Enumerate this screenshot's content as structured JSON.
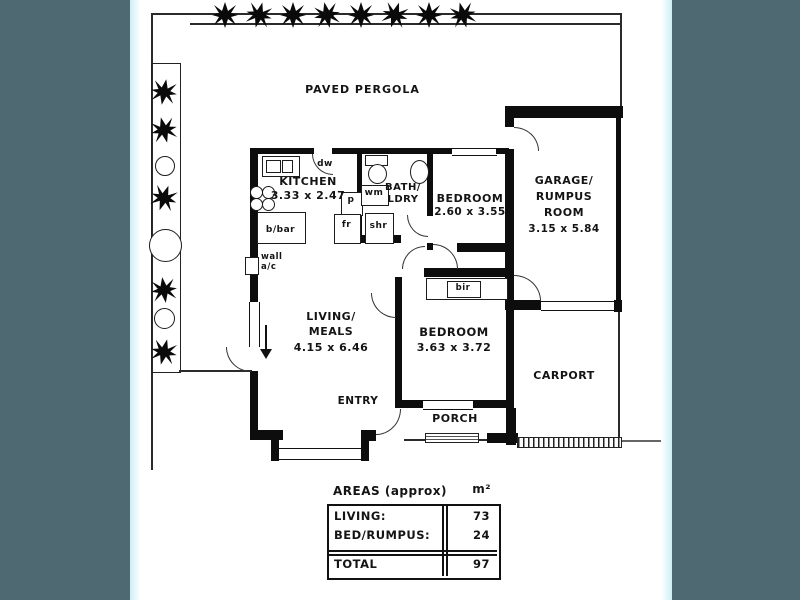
{
  "plan": {
    "pergola_label": "PAVED PERGOLA",
    "rooms": {
      "kitchen": {
        "name": "KITCHEN",
        "dims": "3.33 x 2.47"
      },
      "bath": {
        "line1": "BATH/",
        "line2": "LDRY"
      },
      "bedroom1": {
        "name": "BEDROOM",
        "dims": "2.60 x 3.55"
      },
      "garage": {
        "line1": "GARAGE/",
        "line2": "RUMPUS",
        "line3": "ROOM",
        "dims": "3.15 x 5.84"
      },
      "living": {
        "line1": "LIVING/",
        "line2": "MEALS",
        "dims": "4.15 x 6.46"
      },
      "bedroom2": {
        "name": "BEDROOM",
        "dims": "3.63 x 3.72"
      },
      "carport": {
        "name": "CARPORT"
      },
      "entry": {
        "name": "ENTRY"
      },
      "porch": {
        "name": "PORCH"
      }
    },
    "fixtures": {
      "dw": "dw",
      "pantry": "p",
      "fridge": "fr",
      "shower": "shr",
      "washing_machine": "wm",
      "breakfast_bar": "b/bar",
      "built_in_robe": "bir",
      "wall_ac_line1": "wall",
      "wall_ac_line2": "a/c"
    }
  },
  "areas_table": {
    "title": "AREAS (approx)",
    "unit": "m²",
    "rows": [
      {
        "label": "LIVING:",
        "value": "73"
      },
      {
        "label": "BED/RUMPUS:",
        "value": "24"
      }
    ],
    "total_label": "TOTAL",
    "total_value": "97"
  },
  "colors": {
    "side_panel": "#4e6972",
    "ink": "#111111"
  }
}
